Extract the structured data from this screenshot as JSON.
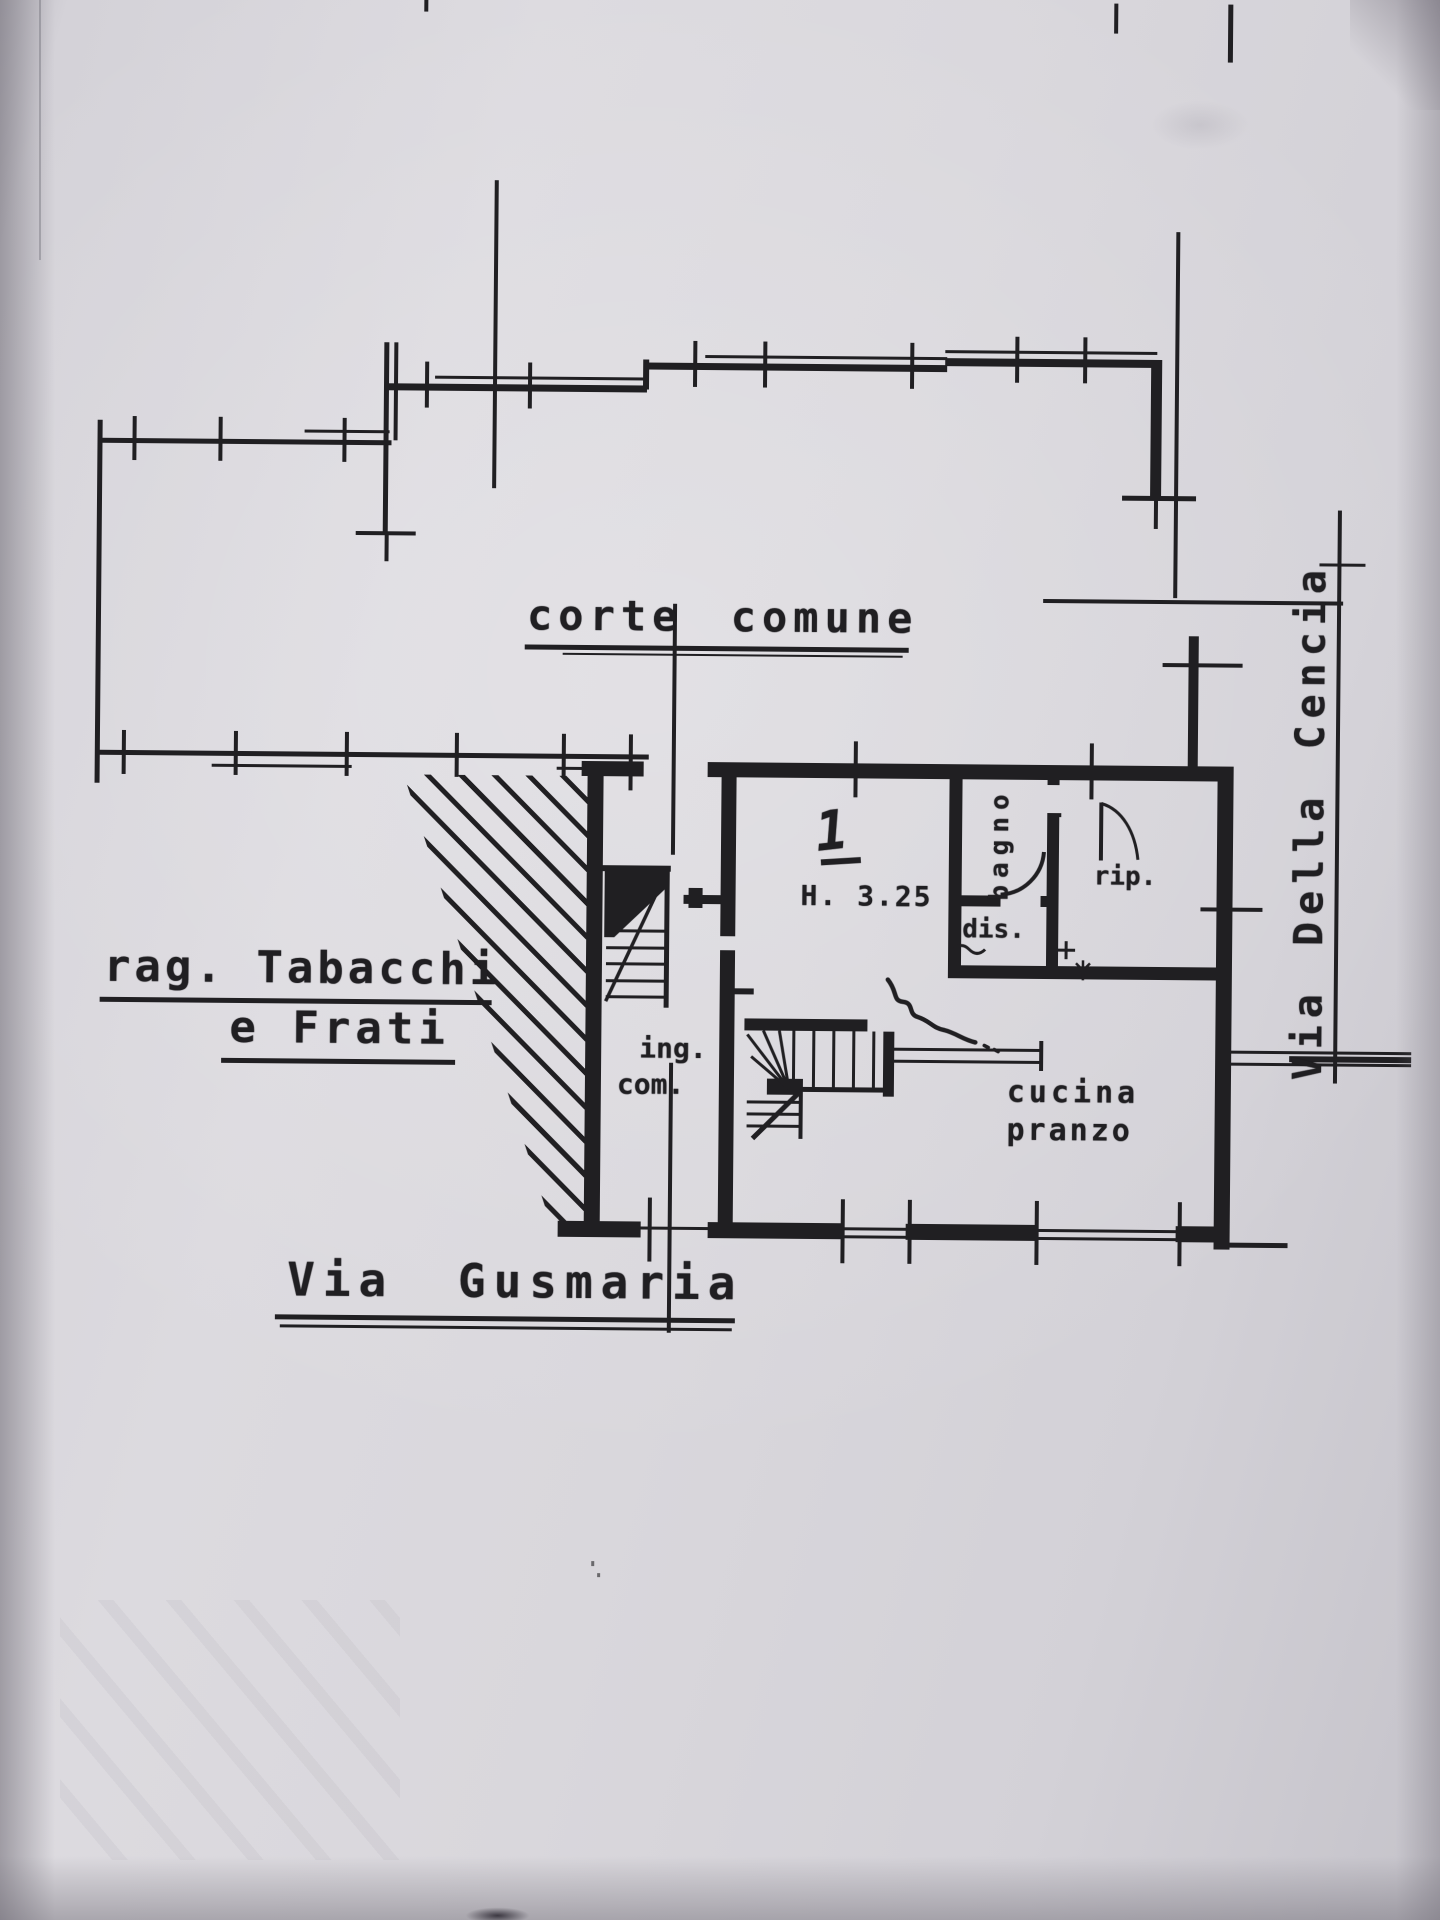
{
  "colors": {
    "paper": "#d8d6db",
    "ink": "#201f22"
  },
  "plan": {
    "courtyard_label": "corte comune",
    "neighbor": {
      "line1": "rag. Tabacchi",
      "line2": "e Frati"
    },
    "streets": {
      "bottom": "Via Gusmaria",
      "right": "Via Della Cencia"
    },
    "unit": {
      "number": "1",
      "height_note": "H. 3.25",
      "rooms": {
        "bagno": "bagno",
        "dis": "dis.",
        "rip": "rip.",
        "ing_line1": "ing.",
        "ing_line2": "com.",
        "cucina_line1": "cucina",
        "cucina_line2": "pranzo"
      }
    }
  }
}
